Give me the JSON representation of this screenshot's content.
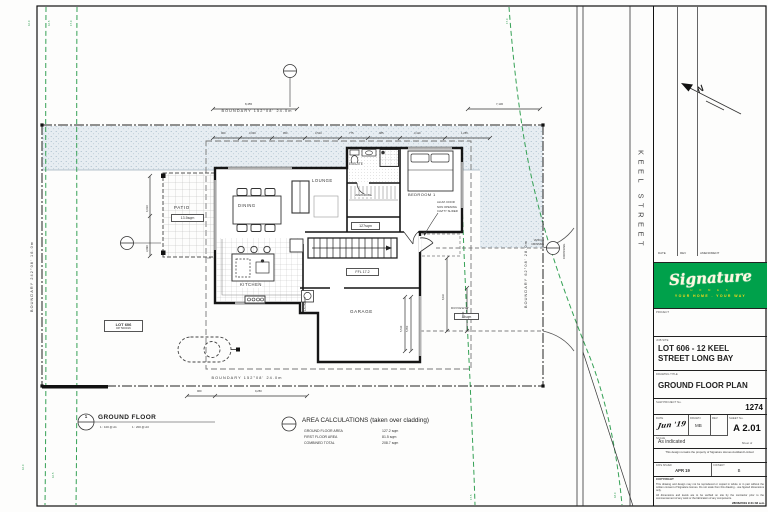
{
  "site": {
    "street_name": "KEEL STREET",
    "north_label": "N",
    "boundary_top": "BOUNDARY 152°08'   24.0m",
    "boundary_bottom": "BOUNDARY 152°08'   24.0m",
    "boundary_left": "BOUNDARY 242°08'   16.0m",
    "boundary_right": "BOUNDARY 62°08'   28.0m",
    "contours": [
      "16.0",
      "16.5",
      "17.0",
      "17.0",
      "17.5",
      "18.0",
      "16.0",
      "16.5"
    ],
    "lot_tag_line1": "LOT 606",
    "lot_tag_line2": "DP 500016",
    "crossing_vertical": "CROSSING",
    "crossing_side1": "VEHICLE",
    "crossing_side2": "CROSSING"
  },
  "plan": {
    "patio": "PATIO",
    "patio_area": "13.5sqm",
    "dining": "DINING",
    "lounge": "LOUNGE",
    "ensuite": "ENSUITE",
    "wardrobe": "WARDROBE",
    "bedroom1": "BEDROOM 1",
    "kitchen": "KITCHEN",
    "laundry": "LAUNDRY",
    "garage": "GARAGE",
    "driveway": "DRIVEWAY",
    "driveway_area": "44sqm",
    "floor_area_tag": "127sqm",
    "ffl_tag": "FFL 17.2",
    "door_note_1": "ALUM. DOOR",
    "door_note_2": "NON OPENING",
    "door_note_3": "CAVITY SLIDER"
  },
  "dims": {
    "top_left_overall": "8,455",
    "top_right_overall": "7,130",
    "s1": "900",
    "s2": "3,000",
    "s3": "950",
    "s4": "3,510",
    "s5": "775",
    "s6": "985",
    "s7": "3,110",
    "s8": "1,255",
    "left_upper": "4,010",
    "left_lower": "3,990",
    "garage_a": "5,510",
    "garage_b": "5,950",
    "drive_a": "8,110",
    "drive_b": "4,910",
    "bottom_a": "960",
    "bottom_b": "9,250"
  },
  "view": {
    "number": "1",
    "title": "GROUND FLOOR",
    "scale_a1": "1 : 100 @ A1",
    "scale_a3": "1 : 200 @ A3"
  },
  "area_calc": {
    "title": "AREA CALCULATIONS (taken over cladding)",
    "r1_label": "GROUND FLOOR AREA",
    "r1_value": "127.2 sqm",
    "r2_label": "FIRST FLOOR AREA",
    "r2_value": "81.5 sqm",
    "r3_label": "COMBINED TOTAL",
    "r3_value": "208.7 sqm"
  },
  "title_block": {
    "rev_date": "DATE",
    "rev_rev": "REV",
    "rev_amendment": "AMENDMENT",
    "logo_script": "Signature",
    "logo_homes": "H O M E S",
    "logo_tagline": "YOUR HOME . YOUR WAY",
    "project_label": "PROJECT",
    "job_site_label": "JOB SITE",
    "job_site_value": "LOT 606 - 12 KEEL STREET LONG BAY",
    "drawing_title_label": "DRAWING TITLE",
    "drawing_title_value": "GROUND FLOOR PLAN",
    "project_no_label": "SHW PROJECT No.",
    "project_no_value": "1274",
    "date_label": "DATE",
    "date_value": "Jun '19",
    "drawn_label": "DRAWN",
    "drawn_value": "MB",
    "rev_label": "REV",
    "sheet_label": "SHEET No.",
    "sheet_value": "A 2.01",
    "sheet_of": "Sheet        of",
    "scale_label": "SCALE",
    "scale_value": "As indicated",
    "ownership_note": "This design remains the property of Signature Homes Auckland Limited",
    "issued_label": "DATE ISSUED",
    "issued_value": "APR 19",
    "consent_label": "CONSENT",
    "consent_value": "B",
    "copyright_title": "COPYRIGHT",
    "copyright_p1": "This drawing and design may not be reproduced or copied in whole or in part without the written consent of Signature Homes. Do not scale from this drawing - use figured dimensions only.",
    "copyright_p2": "All dimensions and levels are to be verified on site by the contractor prior to the commencement of any work or the fabrication of any components.",
    "print_stamp": "28/06/2019 9:41:32 a.m."
  }
}
